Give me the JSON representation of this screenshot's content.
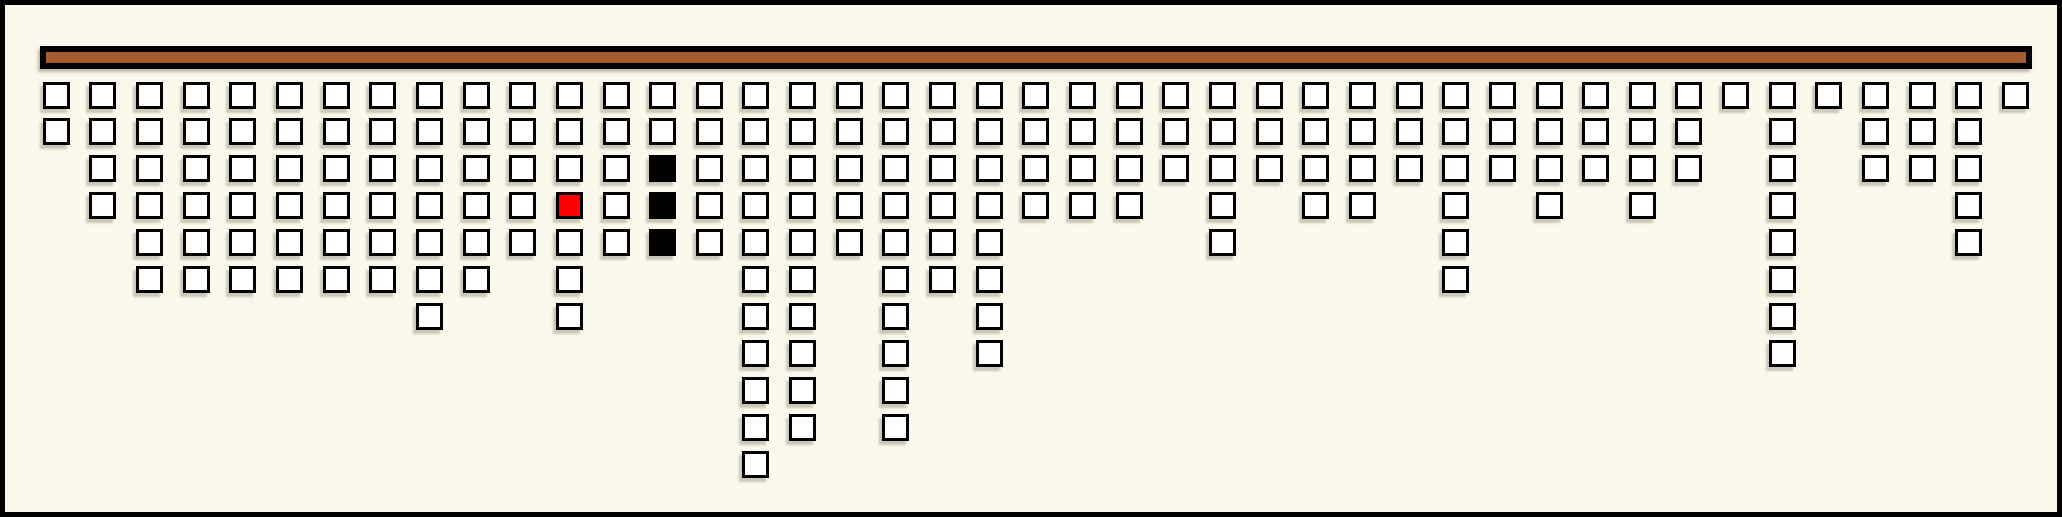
{
  "board": {
    "background_color": "#FBF9EB",
    "frame_color": "#000000",
    "bar": {
      "fill_color": "#A55C30",
      "border_color": "#000000"
    }
  },
  "cell_colors": {
    "white": "#FFFFFF",
    "black": "#000000",
    "red": "#FB0000"
  },
  "chart_data": {
    "type": "bar",
    "title": "",
    "xlabel": "",
    "ylabel": "",
    "orientation": "columns of square cells hang downward from a top rail",
    "num_columns": 43,
    "max_column_height": 11,
    "categories": [
      1,
      2,
      3,
      4,
      5,
      6,
      7,
      8,
      9,
      10,
      11,
      12,
      13,
      14,
      15,
      16,
      17,
      18,
      19,
      20,
      21,
      22,
      23,
      24,
      25,
      26,
      27,
      28,
      29,
      30,
      31,
      32,
      33,
      34,
      35,
      36,
      37,
      38,
      39,
      40,
      41,
      42,
      43
    ],
    "values": [
      2,
      4,
      6,
      6,
      6,
      6,
      6,
      6,
      7,
      6,
      5,
      7,
      5,
      5,
      5,
      11,
      10,
      5,
      10,
      6,
      8,
      4,
      4,
      4,
      3,
      5,
      3,
      4,
      4,
      3,
      6,
      3,
      4,
      3,
      4,
      3,
      1,
      8,
      1,
      3,
      3,
      5,
      1
    ],
    "default_cell_color": "white",
    "special_cells": [
      {
        "column": 12,
        "row": 4,
        "color": "red"
      },
      {
        "column": 14,
        "row": 3,
        "color": "black"
      },
      {
        "column": 14,
        "row": 4,
        "color": "black"
      },
      {
        "column": 14,
        "row": 5,
        "color": "black"
      }
    ],
    "grid": false,
    "legend_position": "none"
  }
}
